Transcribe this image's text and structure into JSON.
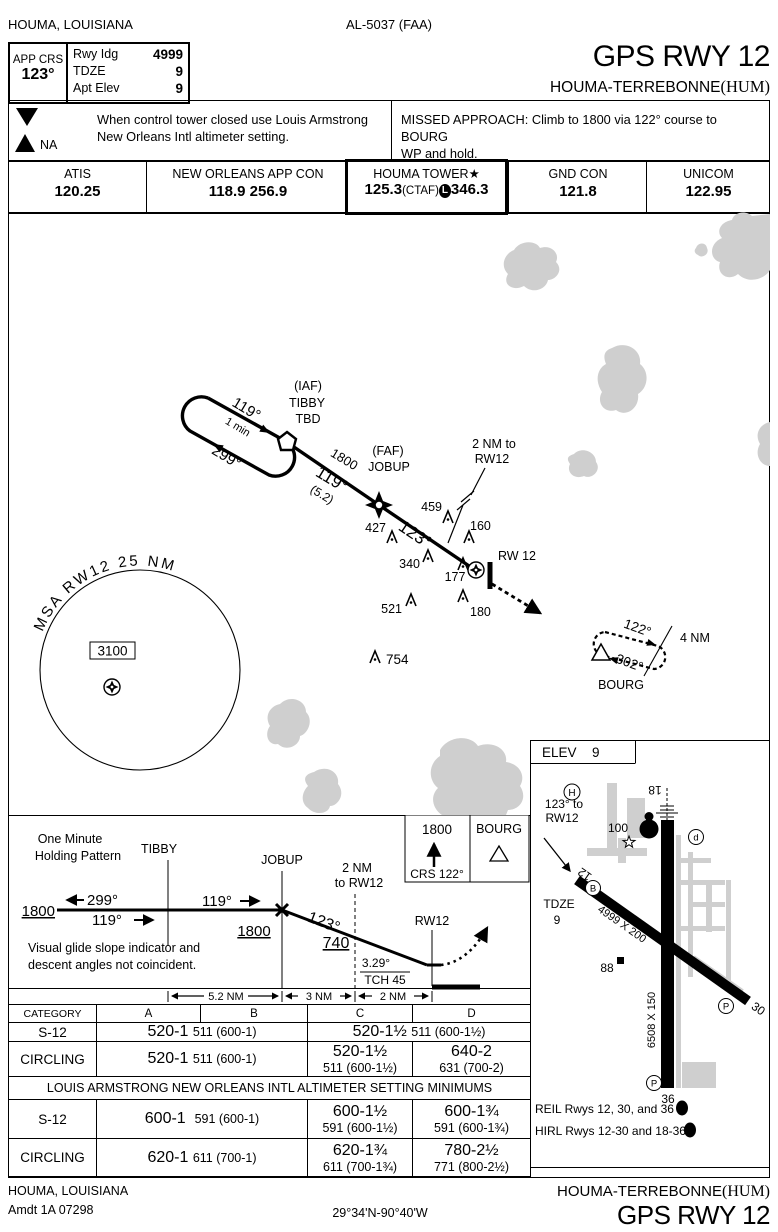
{
  "margin": {
    "city_state": "HOUMA, LOUISIANA",
    "chart_code": "AL-5037 (FAA)",
    "footer_city": "HOUMA, LOUISIANA",
    "amdt": "Amdt 1A  07298",
    "coords": "29°34'N-90°40'W"
  },
  "title": {
    "procedure": "GPS RWY 12",
    "airport": "HOUMA-TERREBONNE",
    "icao": "(HUM)"
  },
  "databox": {
    "app_crs_label": "APP CRS",
    "app_crs": "123°",
    "rwy_ldg_label": "Rwy Idg",
    "rwy_ldg": "4999",
    "tdze_label": "TDZE",
    "tdze": "9",
    "apt_elev_label": "Apt Elev",
    "apt_elev": "9"
  },
  "notes": {
    "t_icon": "T",
    "a_icon": "A",
    "na": "NA",
    "line1": "When control tower closed use Louis Armstrong",
    "line2": "New Orleans Intl altimeter setting.",
    "ma_line1": "MISSED APPROACH:  Climb to 1800 via 122° course to BOURG",
    "ma_line2": "WP and hold."
  },
  "freqs": {
    "atis_label": "ATIS",
    "atis": "120.25",
    "appcon_label": "NEW ORLEANS APP CON",
    "appcon": "118.9 256.9",
    "tower_label": "HOUMA TOWER",
    "tower_star": "★",
    "tower_v1": "125.3",
    "tower_ctaf": "(CTAF)",
    "tower_l": "L",
    "tower_v2": "346.3",
    "gnd_label": "GND CON",
    "gnd": "121.8",
    "unicom_label": "UNICOM",
    "unicom": "122.95"
  },
  "plan": {
    "iaf": "(IAF)",
    "tibby": "TIBBY",
    "tbd": "TBD",
    "hold_inbd": "119°",
    "hold_time": "1 min",
    "hold_outbd": "299°",
    "leg1_alt": "1800",
    "leg1_crs": "119°",
    "leg1_dist": "(5.2)",
    "faf": "(FAF)",
    "jobup": "JOBUP",
    "final_crs": "123°",
    "lead1": "2 NM to",
    "lead2": "RW12",
    "rw12": "RW 12",
    "obs_459": "459",
    "obs_160": "160",
    "obs_427": "427",
    "obs_340": "340",
    "obs_177": "177",
    "obs_521": "521",
    "obs_180": "180",
    "obs_754": "754",
    "msa_arc": "MSA RW12 25 NM",
    "msa_alt": "3100",
    "bourg": "BOURG",
    "bourg_inbd": "122°",
    "bourg_outbd": "302°",
    "bourg_leg": "4 NM"
  },
  "sketch": {
    "elev_label": "ELEV",
    "elev": "9",
    "helipad": "H",
    "crs1": "123° to",
    "crs2": "RW12",
    "val100": "100",
    "beacon": "A5",
    "rwy18": "18",
    "rwy12": "12",
    "rwy30": "30",
    "rwy36": "36",
    "dim_1230": "4999 X 200",
    "dim_1836": "6508 X 150",
    "tdze_label": "TDZE",
    "tdze": "9",
    "obs88": "88",
    "twy_b": "B",
    "twy_d": "d",
    "twy_p1": "P",
    "twy_p2": "P",
    "reil": "REIL Rwys 12, 30, and 36",
    "reil_l": "L",
    "hirl": "HIRL Rwys 12-30 and 18-36",
    "hirl_l": "L"
  },
  "profile": {
    "hold1": "One Minute",
    "hold2": "Holding Pattern",
    "tibby": "TIBBY",
    "jobup": "JOBUP",
    "alt1800_l": "1800",
    "out299": "299°",
    "in119": "119°",
    "crs119": "119°",
    "alt1800_m": "1800",
    "crs123": "123°",
    "alt740": "740",
    "lead1": "2 NM",
    "lead2": "to RW12",
    "rw12": "RW12",
    "gs": "3.29°",
    "tch": "TCH 45",
    "vgsi1": "Visual glide slope indicator and",
    "vgsi2": "descent angles not coincident.",
    "d1": "5.2 NM",
    "d2": "3 NM",
    "d3": "2 NM",
    "ma_alt": "1800",
    "ma_crs": "CRS 122°",
    "ma_fix": "BOURG"
  },
  "minimums": {
    "category": "CATEGORY",
    "a": "A",
    "b": "B",
    "c": "C",
    "d": "D",
    "r1_label": "S-12",
    "r1_ab": "520-1",
    "r1_ab_sub": "511 (600-1)",
    "r1_cd": "520-1½",
    "r1_cd_sub": "511 (600-1½)",
    "r2_label": "CIRCLING",
    "r2_ab": "520-1",
    "r2_ab_sub": "511 (600-1)",
    "r2_c1": "520-1½",
    "r2_c2": "511 (600-1½)",
    "r2_d1": "640-2",
    "r2_d2": "631 (700-2)",
    "band": "LOUIS ARMSTRONG NEW ORLEANS INTL ALTIMETER SETTING MINIMUMS",
    "r3_label": "S-12",
    "r3_ab": "600-1",
    "r3_ab_sub": "591 (600-1)",
    "r3_c1": "600-1½",
    "r3_c2": "591 (600-1½)",
    "r3_d1": "600-1¾",
    "r3_d2": "591 (600-1¾)",
    "r4_label": "CIRCLING",
    "r4_ab": "620-1",
    "r4_ab_sub": "611 (700-1)",
    "r4_c1": "620-1¾",
    "r4_c2": "611 (700-1¾)",
    "r4_d1": "780-2½",
    "r4_d2": "771 (800-2½)"
  }
}
